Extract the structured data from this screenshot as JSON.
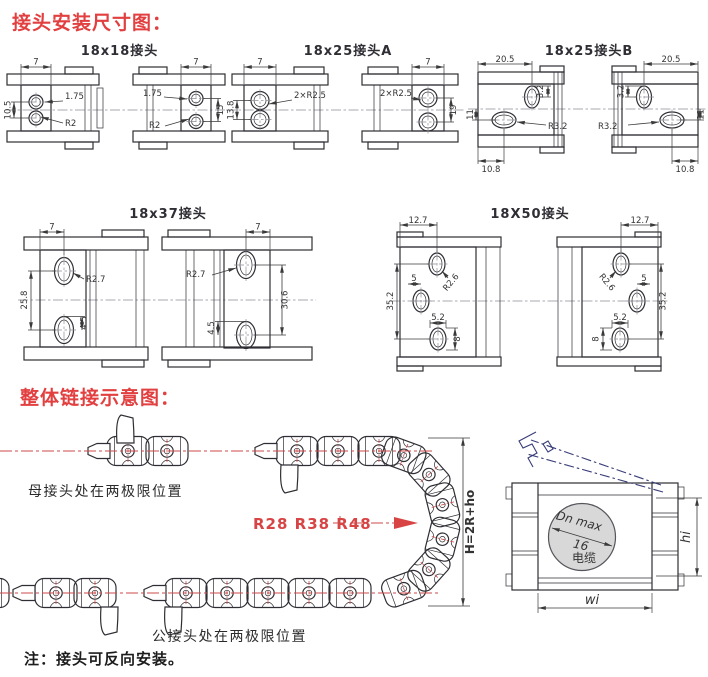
{
  "page": {
    "section1_title": "接头安装尺寸图：",
    "section2_title": "整体链接示意图：",
    "note": "注：接头可反向安装。"
  },
  "colors": {
    "accent_red": "#e24040",
    "centerline_red": "#cf4a4a",
    "drawing_line": "#2e2e34",
    "cover_navy": "#383d78",
    "cable_circle_fill": "#d8d8d8"
  },
  "diagrams": {
    "d18x18": {
      "title": "18x18接头",
      "dims": {
        "lv_width": "7",
        "lv_pitch": "10.5",
        "lv_offset": "1.75",
        "lv_radius": "R2",
        "rv_offset": "1.75",
        "rv_width": "7",
        "rv_pitch": "15",
        "rv_radius": "R2"
      }
    },
    "d18x25a": {
      "title": "18x25接头A",
      "dims": {
        "lv_width": "7",
        "lv_pitch": "13.8",
        "lv_radius": "2×R2.5",
        "rv_radius": "2×R2.5",
        "rv_width": "7",
        "rv_pitch": "19"
      }
    },
    "d18x25b": {
      "title": "18x25接头B",
      "dims": {
        "lv_width": "20.5",
        "lv_slot": "3.2",
        "lv_pitch": "11",
        "lv_radius": "R3.2",
        "lv_bottom": "10.8",
        "rv_width": "20.5",
        "rv_slot": "3.2",
        "rv_pitch": "11",
        "rv_radius": "R3.2",
        "rv_bottom": "10.8"
      }
    },
    "d18x37": {
      "title": "18x37接头",
      "dims": {
        "lv_width": "7",
        "lv_radius": "R2.7",
        "lv_pitch": "25.8",
        "lv_slot": "4.5",
        "rv_width": "7",
        "rv_radius": "R2.7",
        "rv_pitch": "30.6",
        "rv_slot": "4.5"
      }
    },
    "d18x50": {
      "title": "18X50接头",
      "dims": {
        "lv_width": "12.7",
        "lv_radius": "R2.6",
        "lv_small": "5",
        "lv_pitch": "35.2",
        "lv_slot_w": "5.2",
        "lv_slot_h": "8",
        "rv_width": "12.7",
        "rv_radius": "R2.6",
        "rv_small": "5",
        "rv_pitch": "35.2",
        "rv_slot_w": "5.2",
        "rv_slot_h": "8"
      }
    }
  },
  "assembly": {
    "female_label": "母接头处在两极限位置",
    "male_label": "公接头处在两极限位置",
    "radius_label": "R28 R38 R48",
    "height_label": "H=2R+ho",
    "cable_max": "Dn max",
    "cable_value": "16",
    "cable_word": "电缆",
    "inner_height": "hi",
    "inner_width": "wi"
  }
}
